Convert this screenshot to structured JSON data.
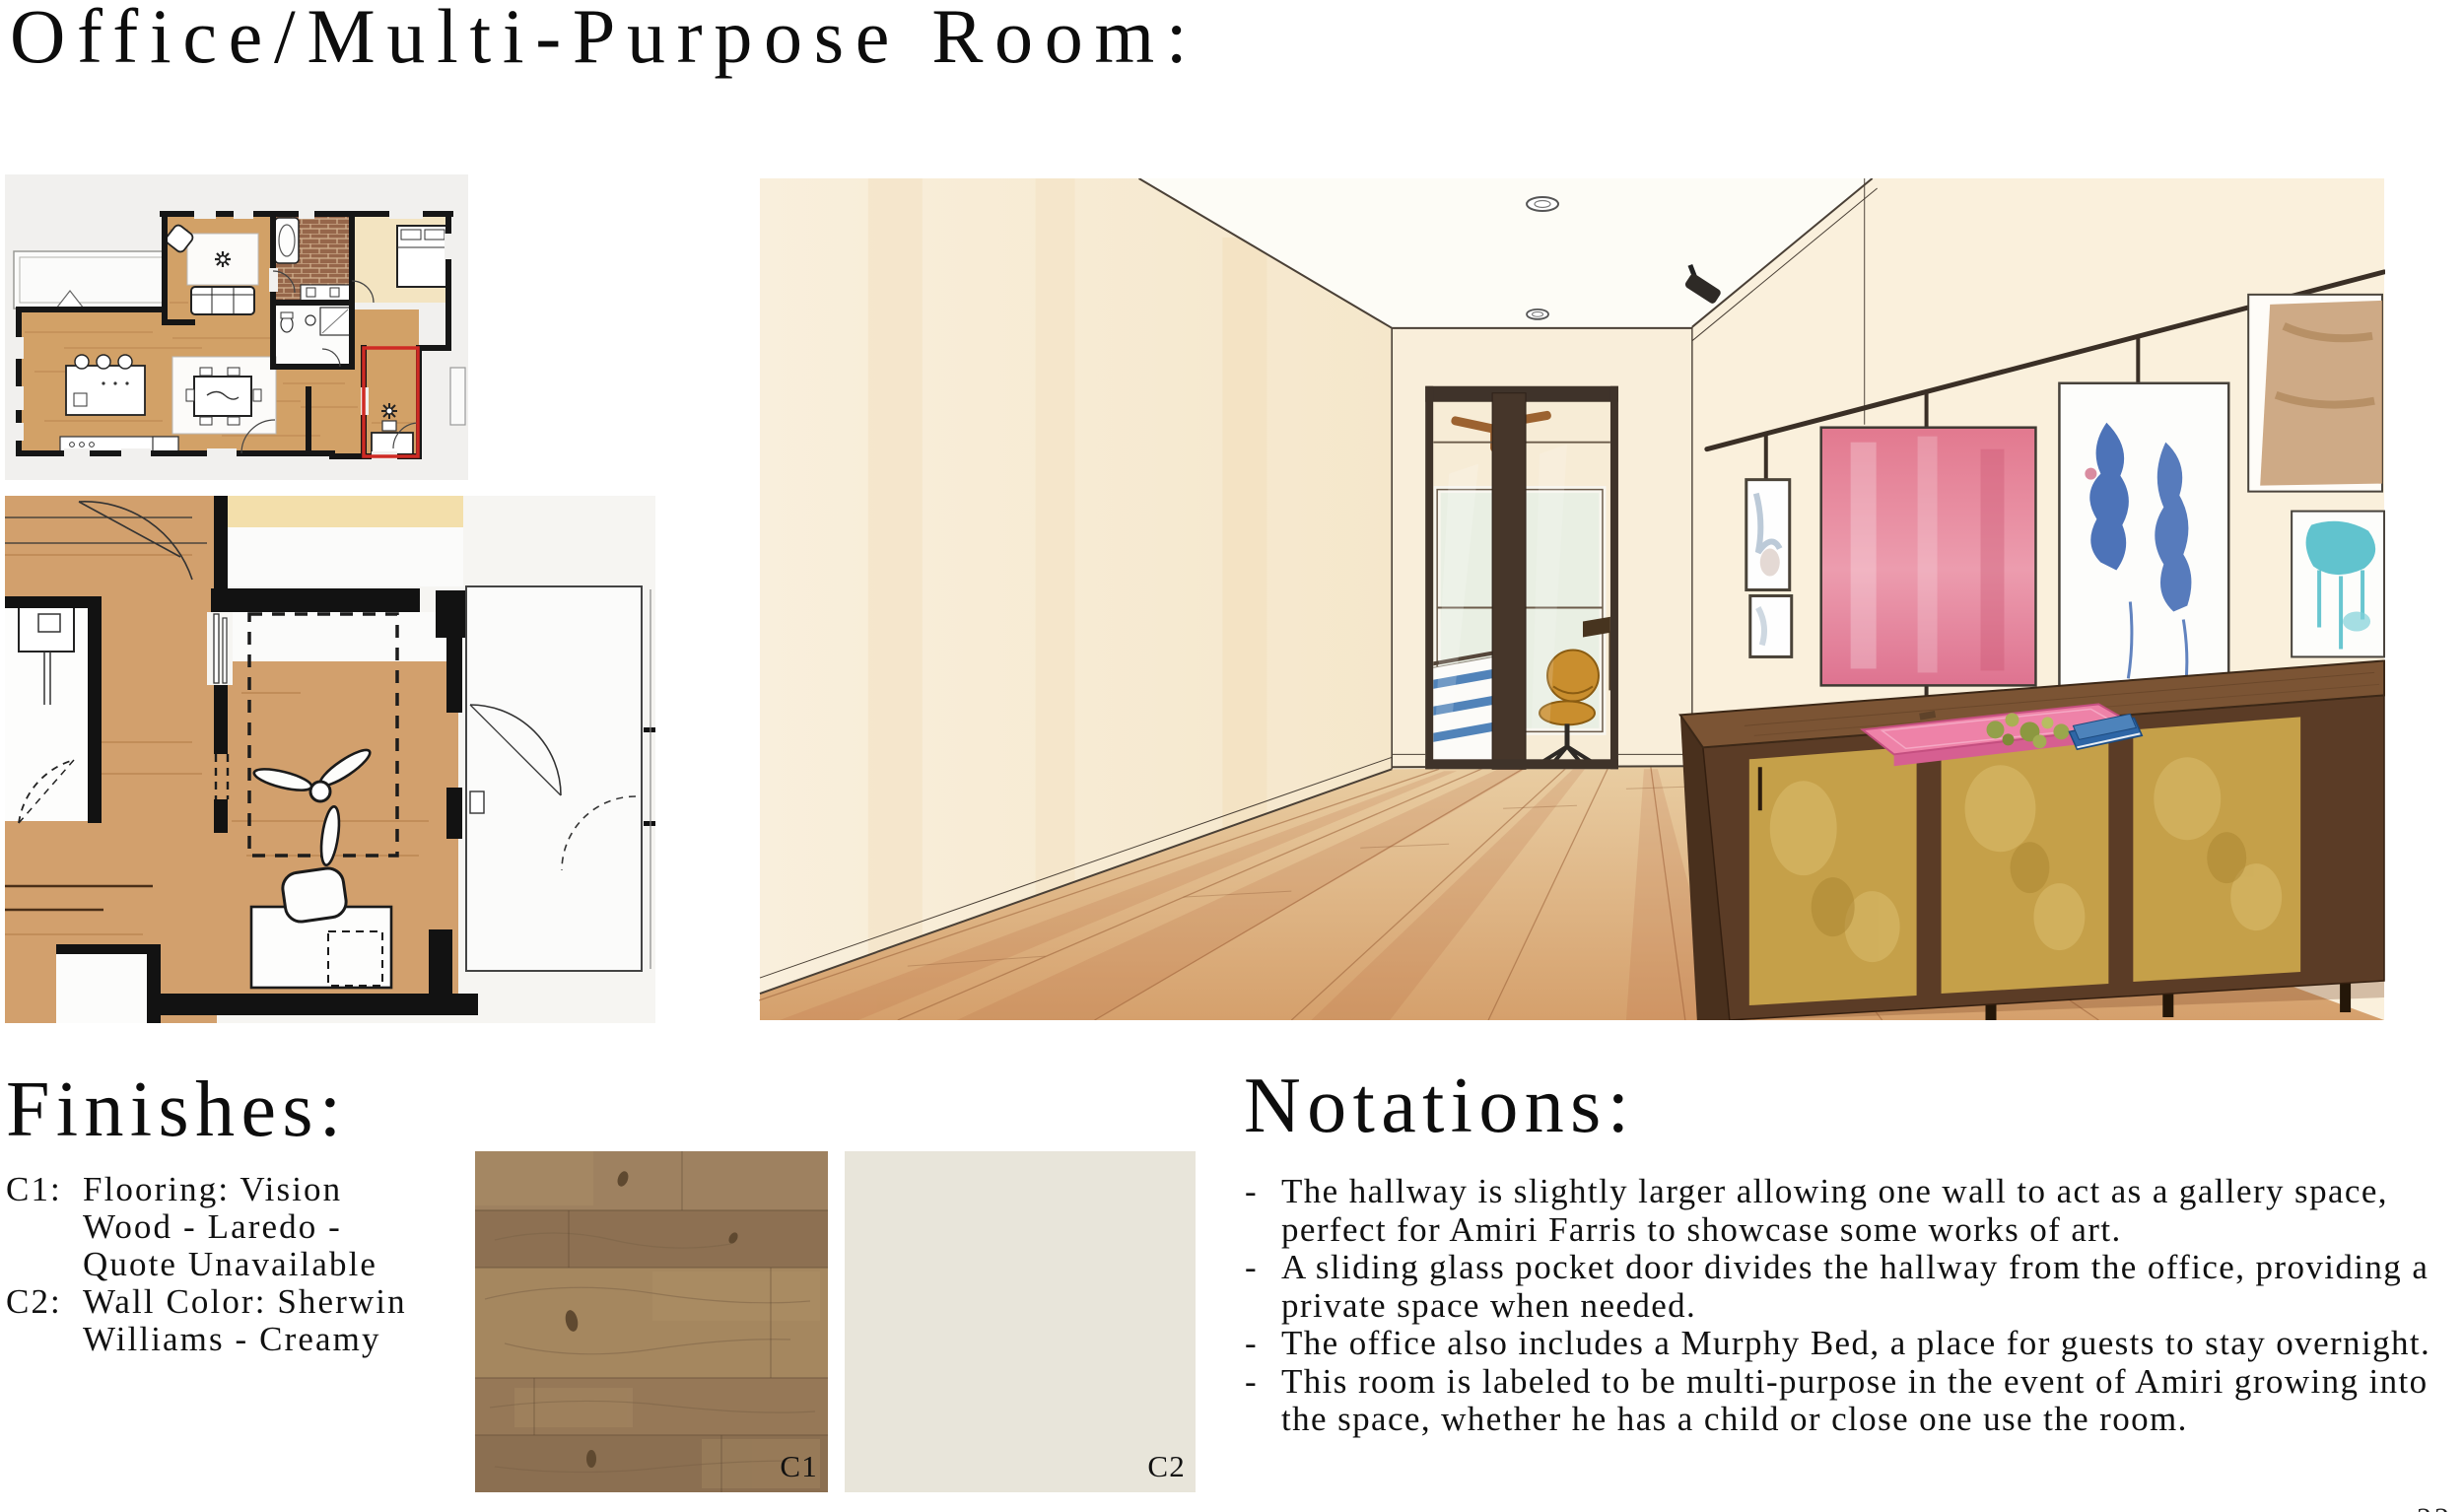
{
  "title": "Office/Multi-Purpose Room:",
  "page_number": "22",
  "finishes": {
    "heading": "Finishes:",
    "items": [
      {
        "label": "C1:",
        "text": "Flooring: Vision Wood - Laredo - Quote Unavailable"
      },
      {
        "label": "C2:",
        "text": "Wall Color: Sherwin Williams - Creamy"
      }
    ]
  },
  "swatches": {
    "c1_label": "C1",
    "c2_label": "C2",
    "c2_color": "#e8e5da"
  },
  "notations": {
    "heading": "Notations:",
    "bullet": "-",
    "items": [
      "The hallway is slightly larger allowing one wall to act as a gallery space, perfect for Amiri Farris to showcase some works of art.",
      "A sliding glass pocket door divides the hallway from the office, providing a private space when needed.",
      "The office also includes a Murphy Bed, a place for guests to stay overnight.",
      "This room is labeled to be multi-purpose in the event of Amiri growing into the space, whether he has a child or close one use the room."
    ]
  },
  "colors": {
    "highlight_red": "#cf2a24",
    "plan_wood": "#d2a167",
    "wall_cream": "#f8eedb",
    "credenza_walnut": "#5b3c26",
    "brass_gold": "#c5a049",
    "tray_pink": "#ee82a8",
    "art_pink": "#e2798f",
    "art_blue": "#3a64b0",
    "art_teal": "#45b9c6",
    "desk_chair_mustard": "#c98e2e"
  }
}
